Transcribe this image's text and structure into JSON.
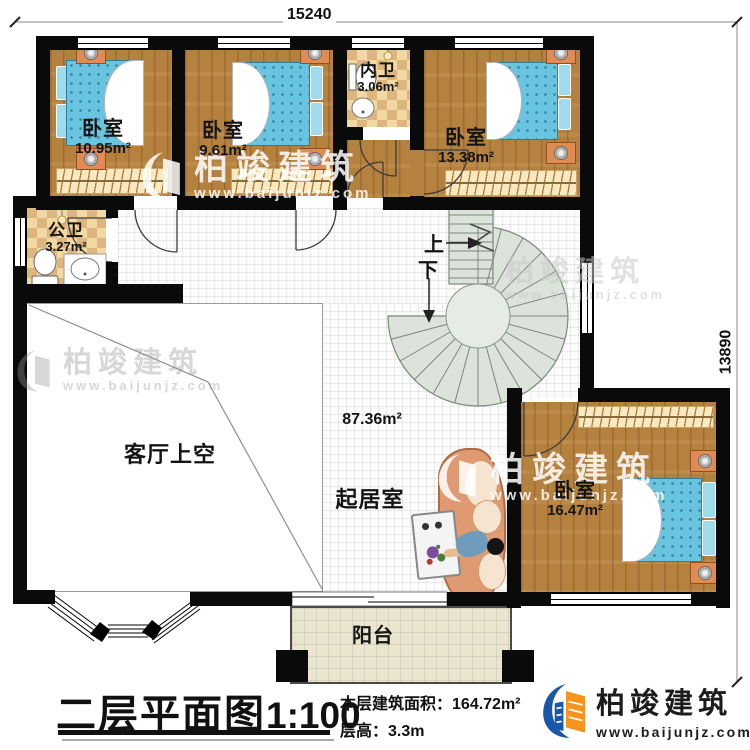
{
  "dimensions": {
    "top": "15240",
    "right": "13890"
  },
  "rooms": {
    "bedroom1": {
      "name": "卧室",
      "area": "10.95m²"
    },
    "bedroom2": {
      "name": "卧室",
      "area": "9.61m²"
    },
    "bedroom3": {
      "name": "卧室",
      "area": "13.38m²"
    },
    "bedroom4": {
      "name": "卧室",
      "area": "16.47m²"
    },
    "inner_bath": {
      "name": "内卫",
      "area": "3.06m²"
    },
    "public_bath": {
      "name": "公卫",
      "area": "3.27m²"
    },
    "void": {
      "name": "客厅上空"
    },
    "living": {
      "name": "起居室",
      "area": "87.36m²"
    },
    "balcony": {
      "name": "阳台"
    }
  },
  "stairs": {
    "up": "上",
    "down": "下"
  },
  "titleblock": {
    "title": "二层平面图",
    "scale": "1:100",
    "area_label": "本层建筑面积：",
    "area_value": "164.72m²",
    "floor_height_label": "层高：",
    "floor_height_value": "3.3m"
  },
  "brand": {
    "name": "柏竣建筑",
    "url": "www.baijunjz.com"
  },
  "watermark": {
    "name": "柏竣建筑",
    "url": "www.baijunjz.com"
  },
  "colors": {
    "wall": "#0a0a0a",
    "wood": "#b5813e",
    "bed": "#68c4df",
    "stair": "#dce3da",
    "checker_light": "#f2d9a4",
    "checker_dark": "#ddb67e",
    "brand_blue": "#1a57a8",
    "brand_orange": "#f7941d"
  }
}
